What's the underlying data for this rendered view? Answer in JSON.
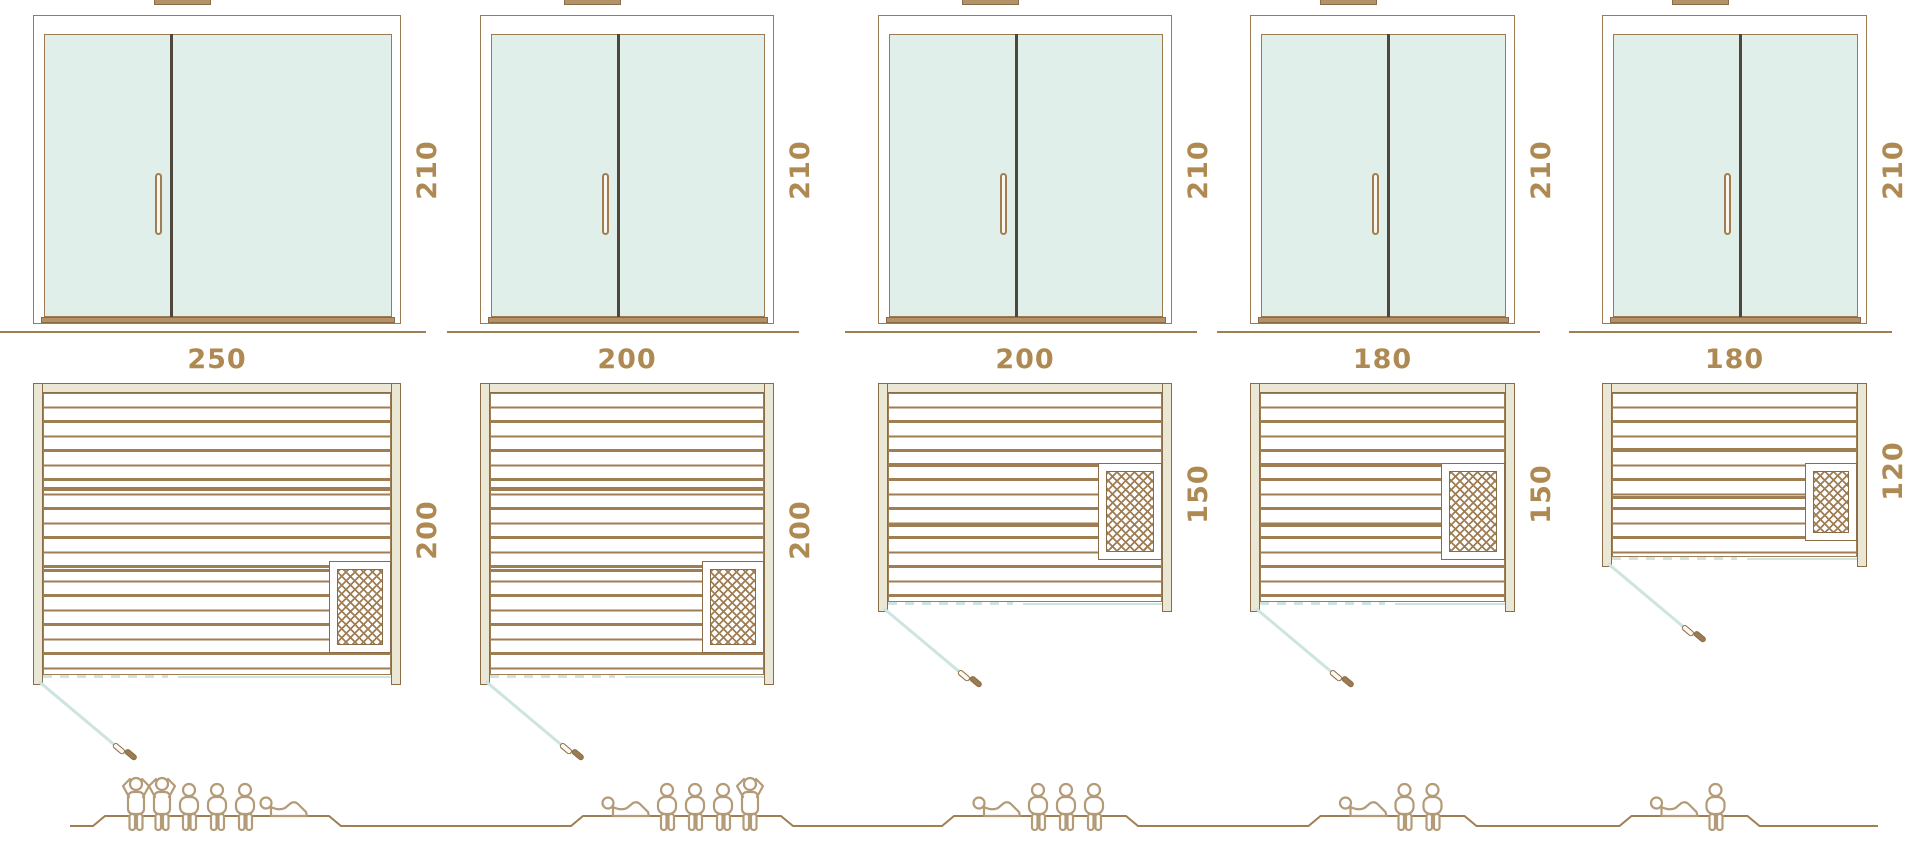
{
  "diagram": {
    "kind": "sauna-size-comparison",
    "door_front": {
      "height_label": "210"
    },
    "saunas": [
      {
        "width_label": "250",
        "depth_label": "200",
        "height_label": "210",
        "width_cm": 250,
        "depth_cm": 200,
        "door_height_cm": 210,
        "capacity": 6,
        "occupants": [
          "standing",
          "standing",
          "seated",
          "seated",
          "seated",
          "lying"
        ],
        "heater_position": "bottom-right"
      },
      {
        "width_label": "200",
        "depth_label": "200",
        "height_label": "210",
        "width_cm": 200,
        "depth_cm": 200,
        "door_height_cm": 210,
        "capacity": 5,
        "occupants": [
          "lying",
          "seated",
          "seated",
          "seated",
          "standing"
        ],
        "heater_position": "bottom-right"
      },
      {
        "width_label": "200",
        "depth_label": "150",
        "height_label": "210",
        "width_cm": 200,
        "depth_cm": 150,
        "door_height_cm": 210,
        "capacity": 4,
        "occupants": [
          "lying",
          "seated",
          "seated",
          "seated"
        ],
        "heater_position": "middle-right"
      },
      {
        "width_label": "180",
        "depth_label": "150",
        "height_label": "210",
        "width_cm": 180,
        "depth_cm": 150,
        "door_height_cm": 210,
        "capacity": 3,
        "occupants": [
          "lying",
          "seated",
          "seated"
        ],
        "heater_position": "middle-right"
      },
      {
        "width_label": "180",
        "depth_label": "120",
        "height_label": "210",
        "width_cm": 180,
        "depth_cm": 120,
        "door_height_cm": 210,
        "capacity": 2,
        "occupants": [
          "lying",
          "seated"
        ],
        "heater_position": "middle-right"
      }
    ],
    "colors": {
      "frame_brown": "#9c7b52",
      "line_brown": "#a07e54",
      "outline_dark": "#8a6c47",
      "text_brown": "#ae8a52",
      "glass_blue": "#e1efeb",
      "wall_beige": "#eae7d5",
      "accent_blue": "#cde4e0",
      "people_tan": "#b39b78",
      "divider_dark": "#4f463c",
      "sill_brown": "#b3926a"
    }
  }
}
